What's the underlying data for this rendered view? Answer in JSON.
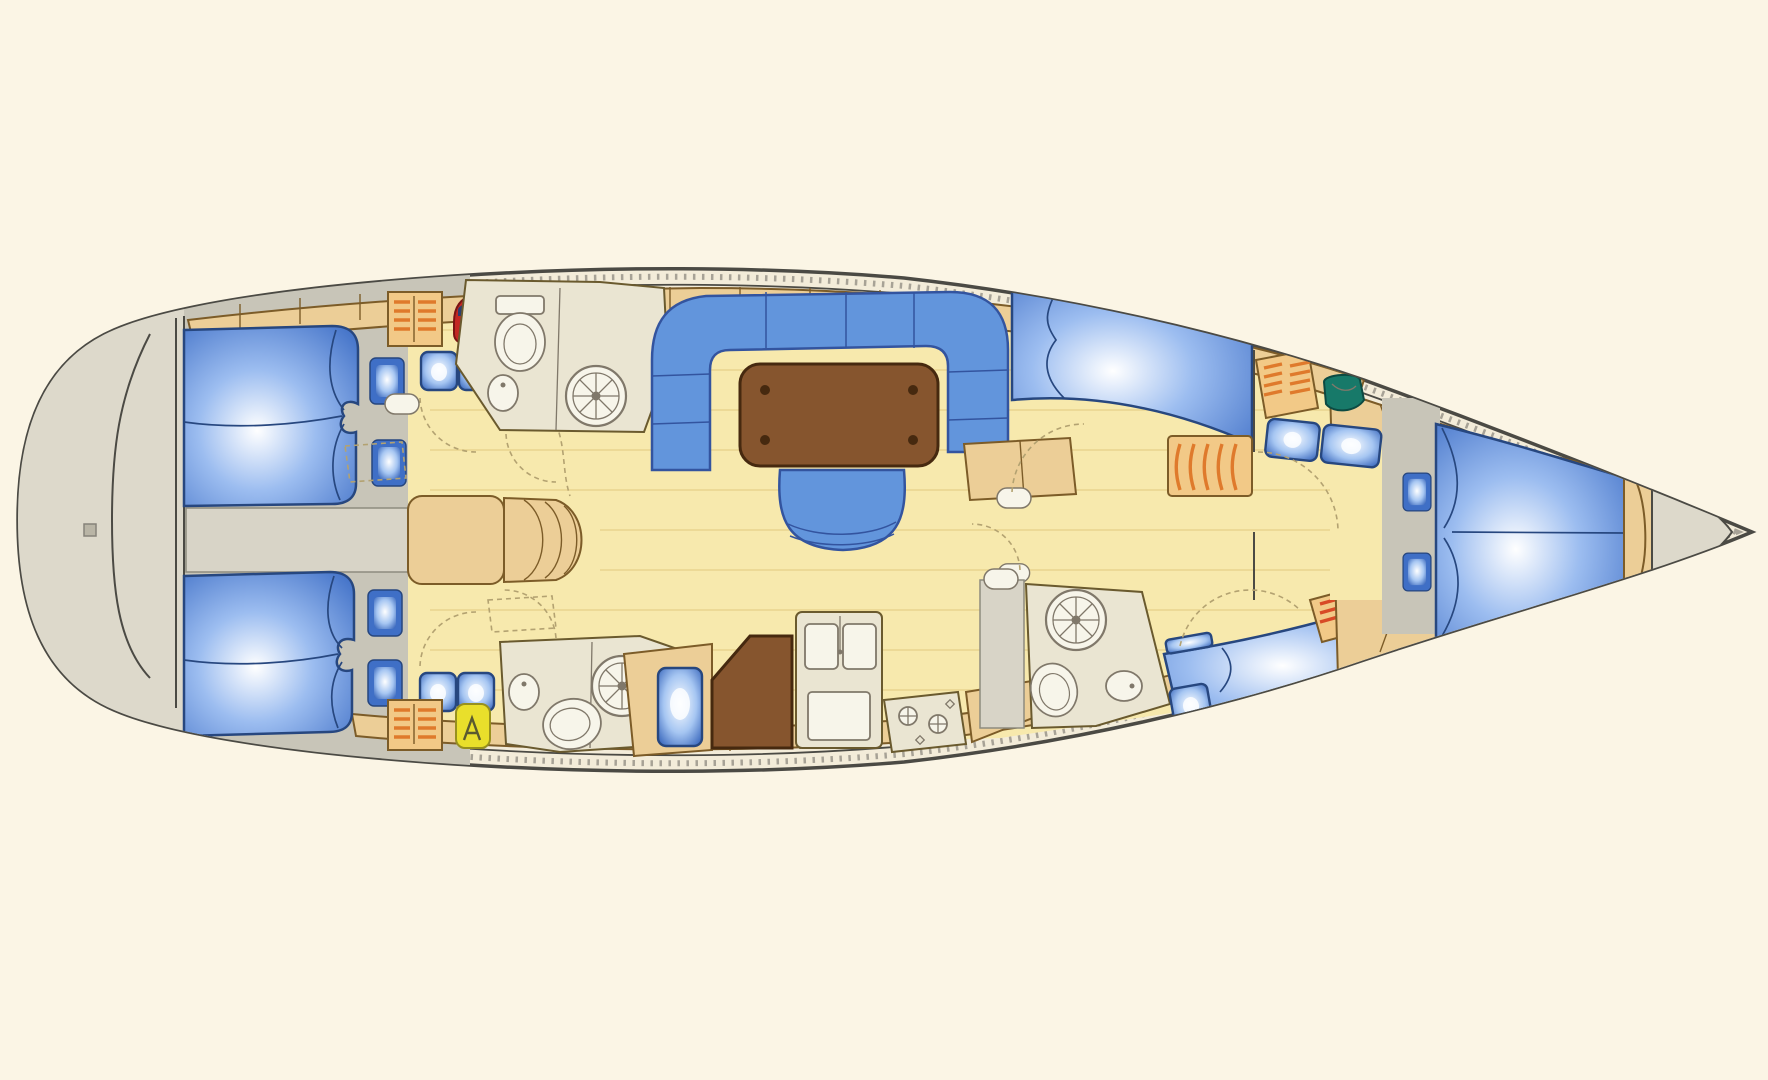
{
  "meta": {
    "type": "floor-plan",
    "subject": "sailing-yacht-interior-layout",
    "orientation_bow": "right",
    "orientation_stern": "left",
    "visible_text": []
  },
  "summary": {
    "double_berth_cabins": 4,
    "v_berth_cabins": 1,
    "heads_with_shower": 3,
    "portlights": 6,
    "salon_tables": 1,
    "companionway_steps": 1,
    "galley_sinks": 2,
    "stove_burners": 2
  },
  "palette": {
    "background": "#fbf5e5",
    "hull_fill": "#f3ecd9",
    "hull_stroke": "#4b4a44",
    "deck_gray": "#ddd9cb",
    "walkway_gray": "#d8d4c7",
    "cabin_gray": "#c8c5b8",
    "floor_yellow": "#f7e9ad",
    "floor_grain": "#e9d48e",
    "wood": "#ecce97",
    "wood_border": "#7c5c28",
    "furniture_outline": "#6a5a2e",
    "berth_blue": "#3f6fc6",
    "berth_blue_light": "#9cbdf0",
    "berth_border": "#27477f",
    "settee_blue": "#6295dc",
    "settee_border": "#33549f",
    "table_brown": "#86552e",
    "table_border": "#46290f",
    "head_floor": "#eae5d2",
    "fixture_white": "#f7f5ea",
    "fixture_stroke": "#80786a",
    "stripe_bg": "#f2c987",
    "stripe_orange": "#df7a2c",
    "red_stripe": "#d84a26",
    "locker_blue": "#3a68bd",
    "locker_light": "#a6c6f2",
    "locker_border": "#27477f",
    "portlight_frame": "#3f6fc6",
    "red_gear": "#c32723",
    "red_gear_cap": "#2c3e6e",
    "yellow_gear": "#e9df2b",
    "green_basin": "#177969",
    "door_dash": "#b3a271"
  },
  "parts": [
    "hull",
    "deck-rail",
    "stern-swim-platform",
    "transom-bulkhead",
    "aft-cabin-port",
    "aft-cabin-starboard",
    "double-berth",
    "hull-portlight",
    "storage-locker-seat",
    "orange-shelf-locker",
    "red-gear-locker",
    "yellow-gear-locker",
    "engine-access-walkway",
    "companionway-landing",
    "companionway-steps",
    "head-port-aft",
    "head-starboard-aft",
    "head-forward-starboard",
    "shower-drain",
    "toilet",
    "washbasin",
    "salon",
    "u-settee",
    "salon-table",
    "salon-stool",
    "sideboard",
    "galley",
    "galley-counter",
    "fridge",
    "chart-table",
    "double-sink",
    "stove",
    "forward-cabin-port",
    "forward-cabin-starboard",
    "wardrobe",
    "green-vanity-basin",
    "v-berth-cabin",
    "v-berth",
    "foot-board",
    "anchor-locker",
    "door-swing",
    "door-leaf",
    "floor-hatch"
  ]
}
